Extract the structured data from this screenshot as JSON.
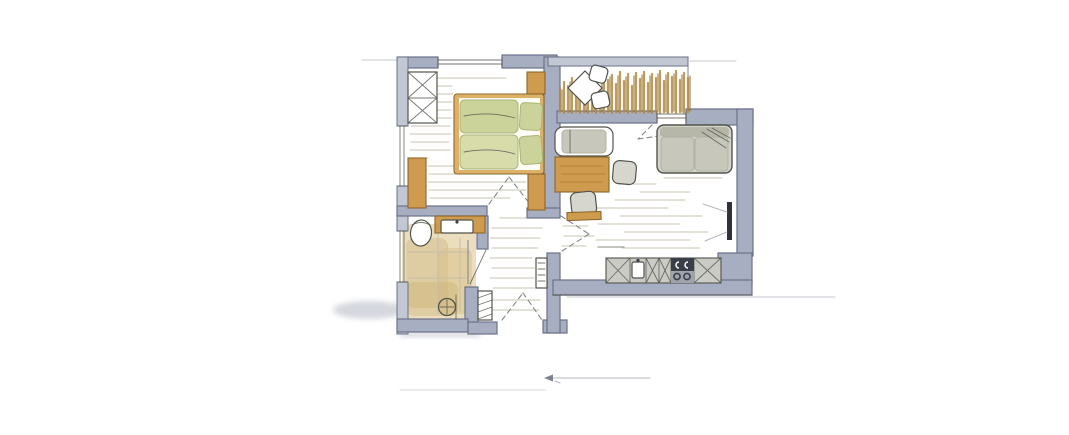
{
  "scene": {
    "description": "Hand-drawn watercolor floor plan sketch of a one-bedroom apartment with balcony, no text labels",
    "medium": "marker and watercolor on white paper",
    "rooms": [
      {
        "id": "bedroom",
        "area": "top-left",
        "items": [
          "wardrobe with cross bracing",
          "double bed with two green duvets and two pillows",
          "nightstand",
          "sideboard",
          "dresser"
        ]
      },
      {
        "id": "balcony",
        "area": "top-center",
        "items": [
          "bistro table",
          "two small chairs",
          "ornamental grasses along railing"
        ]
      },
      {
        "id": "living-room",
        "area": "right",
        "items": [
          "daybed",
          "wooden dining table",
          "two chairs",
          "bench",
          "two-seat sofa with throw",
          "wall TV",
          "kitchenette"
        ]
      },
      {
        "id": "kitchenette",
        "area": "south wall of living room",
        "items": [
          "base cabinets with cross fronts",
          "sink with faucet",
          "cooktop with knobs and burners"
        ]
      },
      {
        "id": "bathroom",
        "area": "bottom-left",
        "items": [
          "toilet",
          "wooden vanity with washbasin",
          "walk-in shower with round drain",
          "glass partition"
        ]
      },
      {
        "id": "hallway",
        "area": "bottom-center",
        "items": [
          "radiator",
          "slatted cabinet",
          "entrance door swing"
        ]
      }
    ],
    "openings": {
      "windows": [
        "bedroom north",
        "bedroom west",
        "bathroom west",
        "living room north (balcony slider)"
      ],
      "doors": [
        "entrance south",
        "bedroom door",
        "bathroom door",
        "living room door",
        "balcony door"
      ]
    },
    "annotations": [
      "faint pencil scale line with left arrow below plan",
      "soft cast shadow at lower-left exterior wall"
    ]
  },
  "colors": {
    "paper": "#ffffff",
    "wall": "#a8aec2",
    "wallLight": "#c2c7d4",
    "wallEdge": "#6b7188",
    "ink": "#52554e",
    "wood": "#cf9c4f",
    "woodLight": "#ddb168",
    "woodDark": "#8d672a",
    "green": "#ccd39a",
    "greenLight": "#d8dcab",
    "greenDark": "#a9b475",
    "tan": "#d9c28b",
    "tanDeep": "#c9ad6e",
    "sofa": "#d3d3c9",
    "sofaShade": "#b0b0a3",
    "sofaCushion": "#c7c7bb",
    "chair": "#d6d6ce",
    "counter": "#c9cbc4",
    "stove": "#3a3f4a",
    "stoveBase": "#9fa3ad",
    "tv": "#2e323b",
    "plant": "#b18a40",
    "plantDark": "#8f6d2a",
    "floorLine": "#c3bcab",
    "dash": "#85878b",
    "glass": "#7d8294",
    "pencil": "#b4b7bf",
    "shadow": "#a2a7b5"
  }
}
